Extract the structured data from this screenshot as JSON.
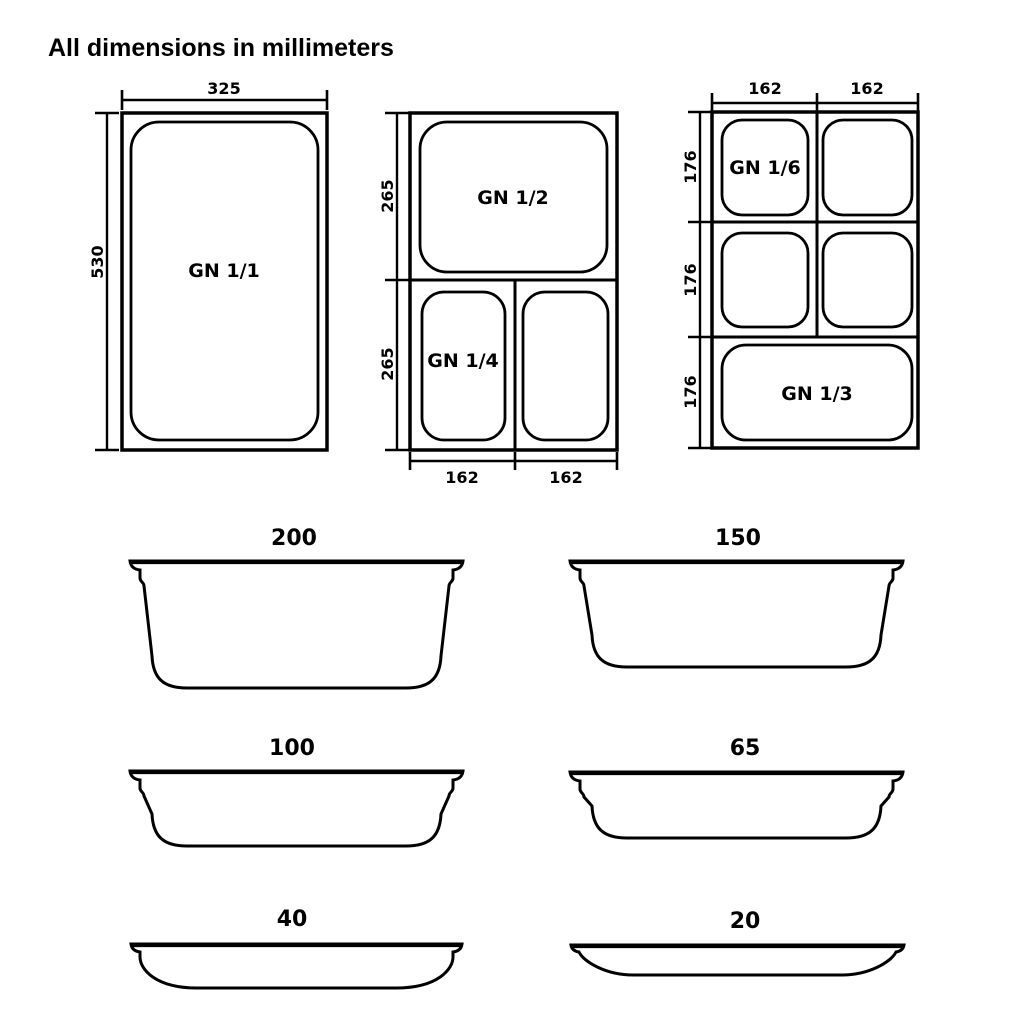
{
  "title": "All dimensions in millimeters",
  "colors": {
    "ink": "#000000",
    "background": "#ffffff"
  },
  "top_views": [
    {
      "label": "GN 1/1",
      "dims": {
        "width": "325",
        "height": "530"
      }
    },
    {
      "labels": {
        "half": "GN 1/2",
        "quarter": "GN 1/4"
      },
      "dims": {
        "upper_height": "265",
        "lower_height": "265",
        "left_width": "162",
        "right_width": "162"
      }
    },
    {
      "labels": {
        "sixth": "GN 1/6",
        "third": "GN 1/3"
      },
      "dims": {
        "left_width": "162",
        "right_width": "162",
        "row_top": "176",
        "row_middle": "176",
        "row_bottom": "176"
      }
    }
  ],
  "profiles": [
    {
      "depth": "200"
    },
    {
      "depth": "150"
    },
    {
      "depth": "100"
    },
    {
      "depth": "65"
    },
    {
      "depth": "40"
    },
    {
      "depth": "20"
    }
  ]
}
